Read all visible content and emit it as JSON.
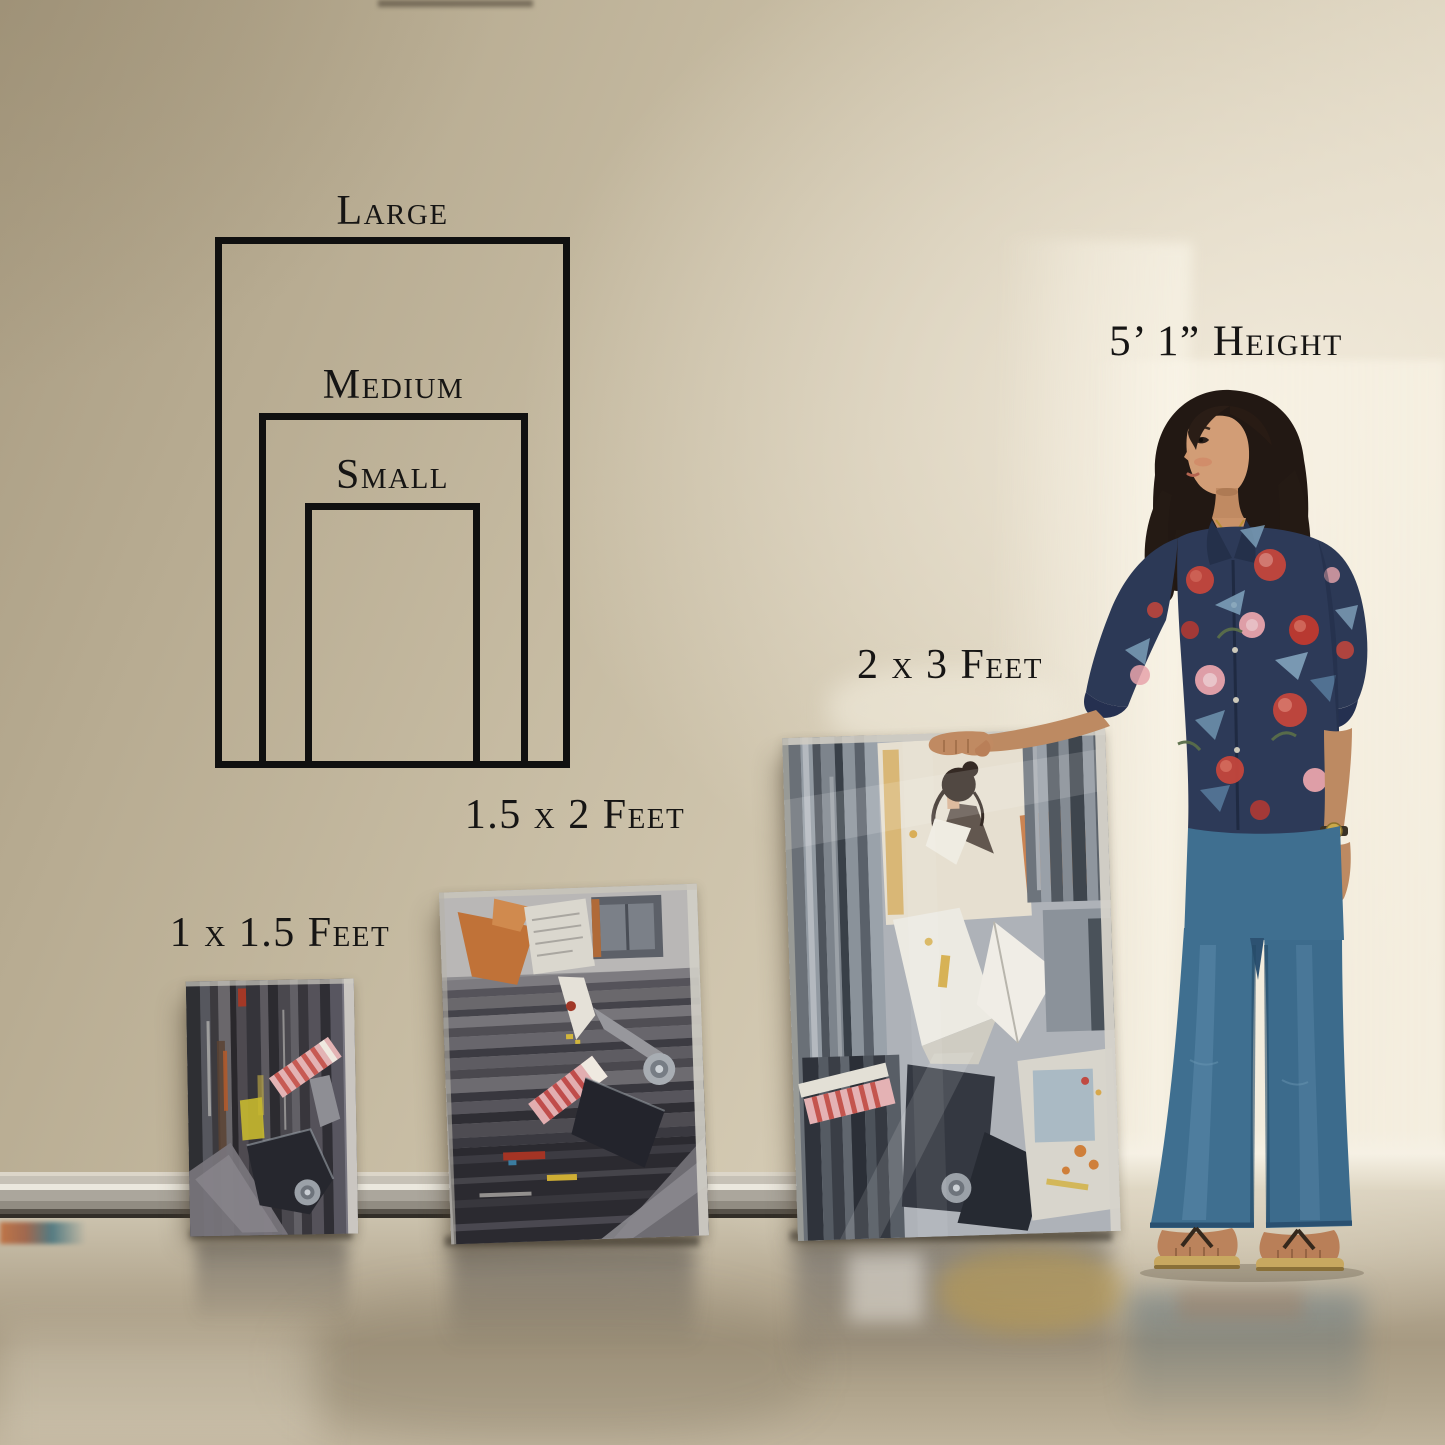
{
  "scene": {
    "description": "Canvas art print size guide on wall with person for scale",
    "wall_color": "#c6bba2",
    "wall_highlight_color": "#efe8d7",
    "floor_color": "#b6aa93",
    "outline_color": "#101010",
    "text_color": "#161514"
  },
  "size_guide": {
    "sizes": [
      {
        "name": "Small",
        "dimensions": "1 x 1.5 Feet"
      },
      {
        "name": "Medium",
        "dimensions": "1.5 x 2 Feet"
      },
      {
        "name": "Large",
        "dimensions": "2 x 3 Feet"
      }
    ],
    "person": {
      "height_label": "5’ 1” Height"
    }
  }
}
